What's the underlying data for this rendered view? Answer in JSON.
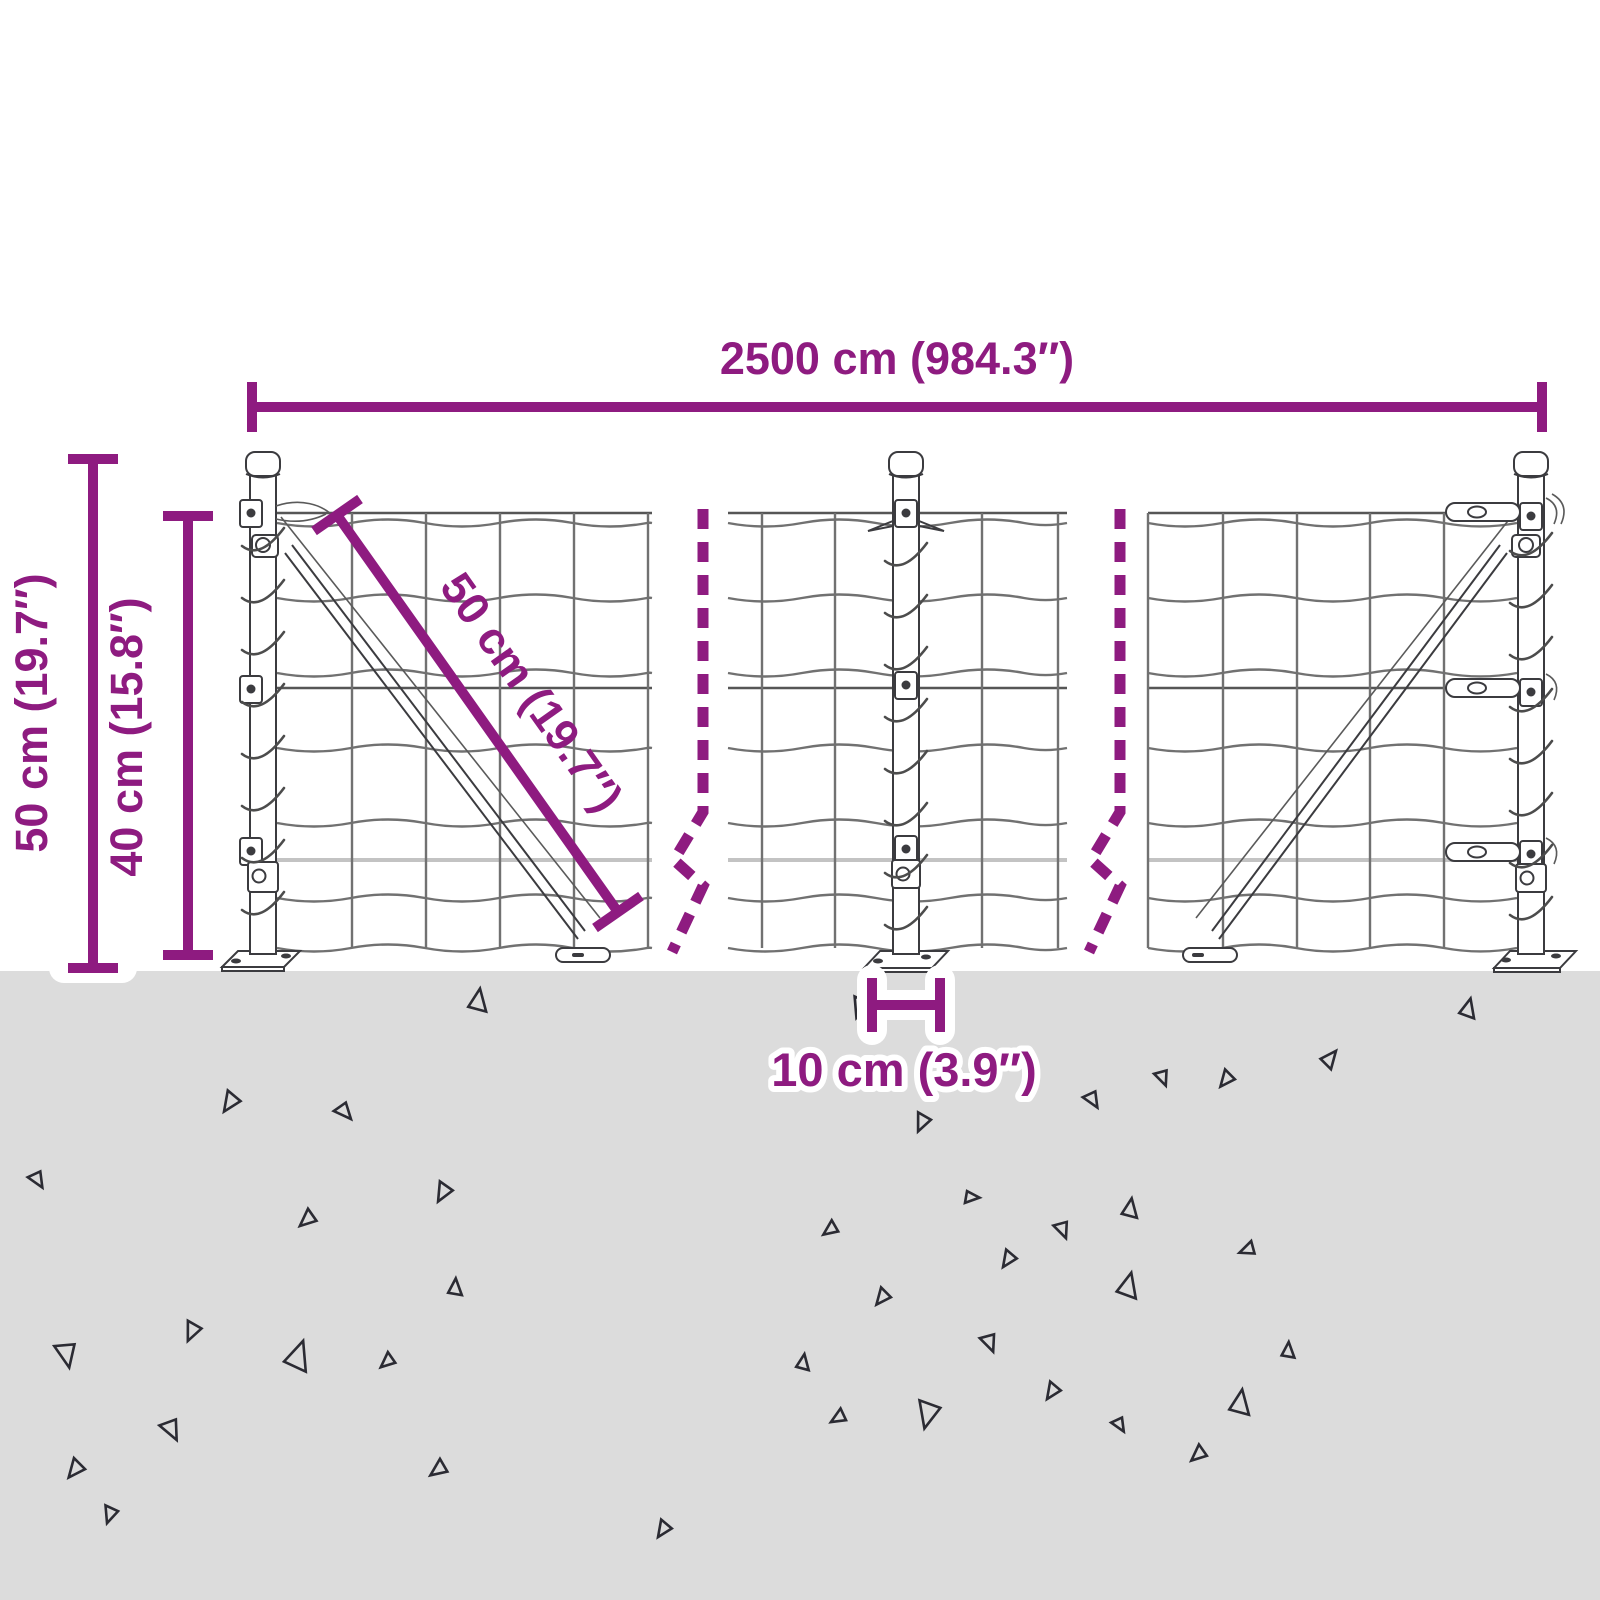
{
  "title": "Wire mesh fence dimension diagram",
  "colors": {
    "accent": "#8e1b80",
    "ground": "#dcdcdc",
    "wire": "#717171",
    "steel": "#3b3b3f",
    "triangle": "#2b2b33"
  },
  "dimensions": {
    "width_label": "2500 cm (984.3″)",
    "total_height_label": "50 cm (19.7″)",
    "mesh_height_label": "40 cm (15.8″)",
    "diagonal_label": "50 cm (19.7″)",
    "depth_label": "10 cm (3.9″)"
  },
  "ground": {
    "triangles": [
      {
        "x": 478,
        "y": 1000,
        "s": 20,
        "r": 10
      },
      {
        "x": 860,
        "y": 1008,
        "s": 18,
        "r": 200
      },
      {
        "x": 1468,
        "y": 1008,
        "s": 17,
        "r": 15
      },
      {
        "x": 1330,
        "y": 1058,
        "s": 16,
        "r": 40
      },
      {
        "x": 1226,
        "y": 1080,
        "s": 15,
        "r": 220
      },
      {
        "x": 1163,
        "y": 1078,
        "s": 14,
        "r": 160
      },
      {
        "x": 1093,
        "y": 1100,
        "s": 15,
        "r": 150
      },
      {
        "x": 922,
        "y": 1123,
        "s": 16,
        "r": 205
      },
      {
        "x": 230,
        "y": 1103,
        "s": 18,
        "r": 215
      },
      {
        "x": 345,
        "y": 1112,
        "s": 16,
        "r": 140
      },
      {
        "x": 38,
        "y": 1180,
        "s": 15,
        "r": 150
      },
      {
        "x": 443,
        "y": 1193,
        "s": 17,
        "r": 210
      },
      {
        "x": 307,
        "y": 1220,
        "s": 16,
        "r": 230
      },
      {
        "x": 972,
        "y": 1197,
        "s": 13,
        "r": 95
      },
      {
        "x": 1130,
        "y": 1208,
        "s": 17,
        "r": 10
      },
      {
        "x": 1063,
        "y": 1230,
        "s": 15,
        "r": 160
      },
      {
        "x": 830,
        "y": 1230,
        "s": 14,
        "r": 235
      },
      {
        "x": 1247,
        "y": 1250,
        "s": 14,
        "r": 250
      },
      {
        "x": 1008,
        "y": 1260,
        "s": 15,
        "r": 215
      },
      {
        "x": 1128,
        "y": 1285,
        "s": 22,
        "r": 15
      },
      {
        "x": 882,
        "y": 1298,
        "s": 15,
        "r": 220
      },
      {
        "x": 455,
        "y": 1287,
        "s": 15,
        "r": 5
      },
      {
        "x": 192,
        "y": 1332,
        "s": 17,
        "r": 205
      },
      {
        "x": 67,
        "y": 1355,
        "s": 22,
        "r": 170
      },
      {
        "x": 298,
        "y": 1355,
        "s": 26,
        "r": 20
      },
      {
        "x": 387,
        "y": 1362,
        "s": 14,
        "r": 230
      },
      {
        "x": 990,
        "y": 1343,
        "s": 16,
        "r": 160
      },
      {
        "x": 803,
        "y": 1362,
        "s": 14,
        "r": 10
      },
      {
        "x": 1288,
        "y": 1350,
        "s": 14,
        "r": 5
      },
      {
        "x": 1052,
        "y": 1392,
        "s": 15,
        "r": 215
      },
      {
        "x": 172,
        "y": 1430,
        "s": 19,
        "r": 155
      },
      {
        "x": 928,
        "y": 1415,
        "s": 24,
        "r": 195
      },
      {
        "x": 838,
        "y": 1418,
        "s": 14,
        "r": 240
      },
      {
        "x": 1240,
        "y": 1402,
        "s": 22,
        "r": 10
      },
      {
        "x": 1120,
        "y": 1425,
        "s": 13,
        "r": 150
      },
      {
        "x": 1198,
        "y": 1455,
        "s": 15,
        "r": 230
      },
      {
        "x": 75,
        "y": 1470,
        "s": 17,
        "r": 220
      },
      {
        "x": 438,
        "y": 1470,
        "s": 16,
        "r": 235
      },
      {
        "x": 663,
        "y": 1530,
        "s": 15,
        "r": 215
      },
      {
        "x": 110,
        "y": 1515,
        "s": 15,
        "r": 200
      }
    ]
  }
}
